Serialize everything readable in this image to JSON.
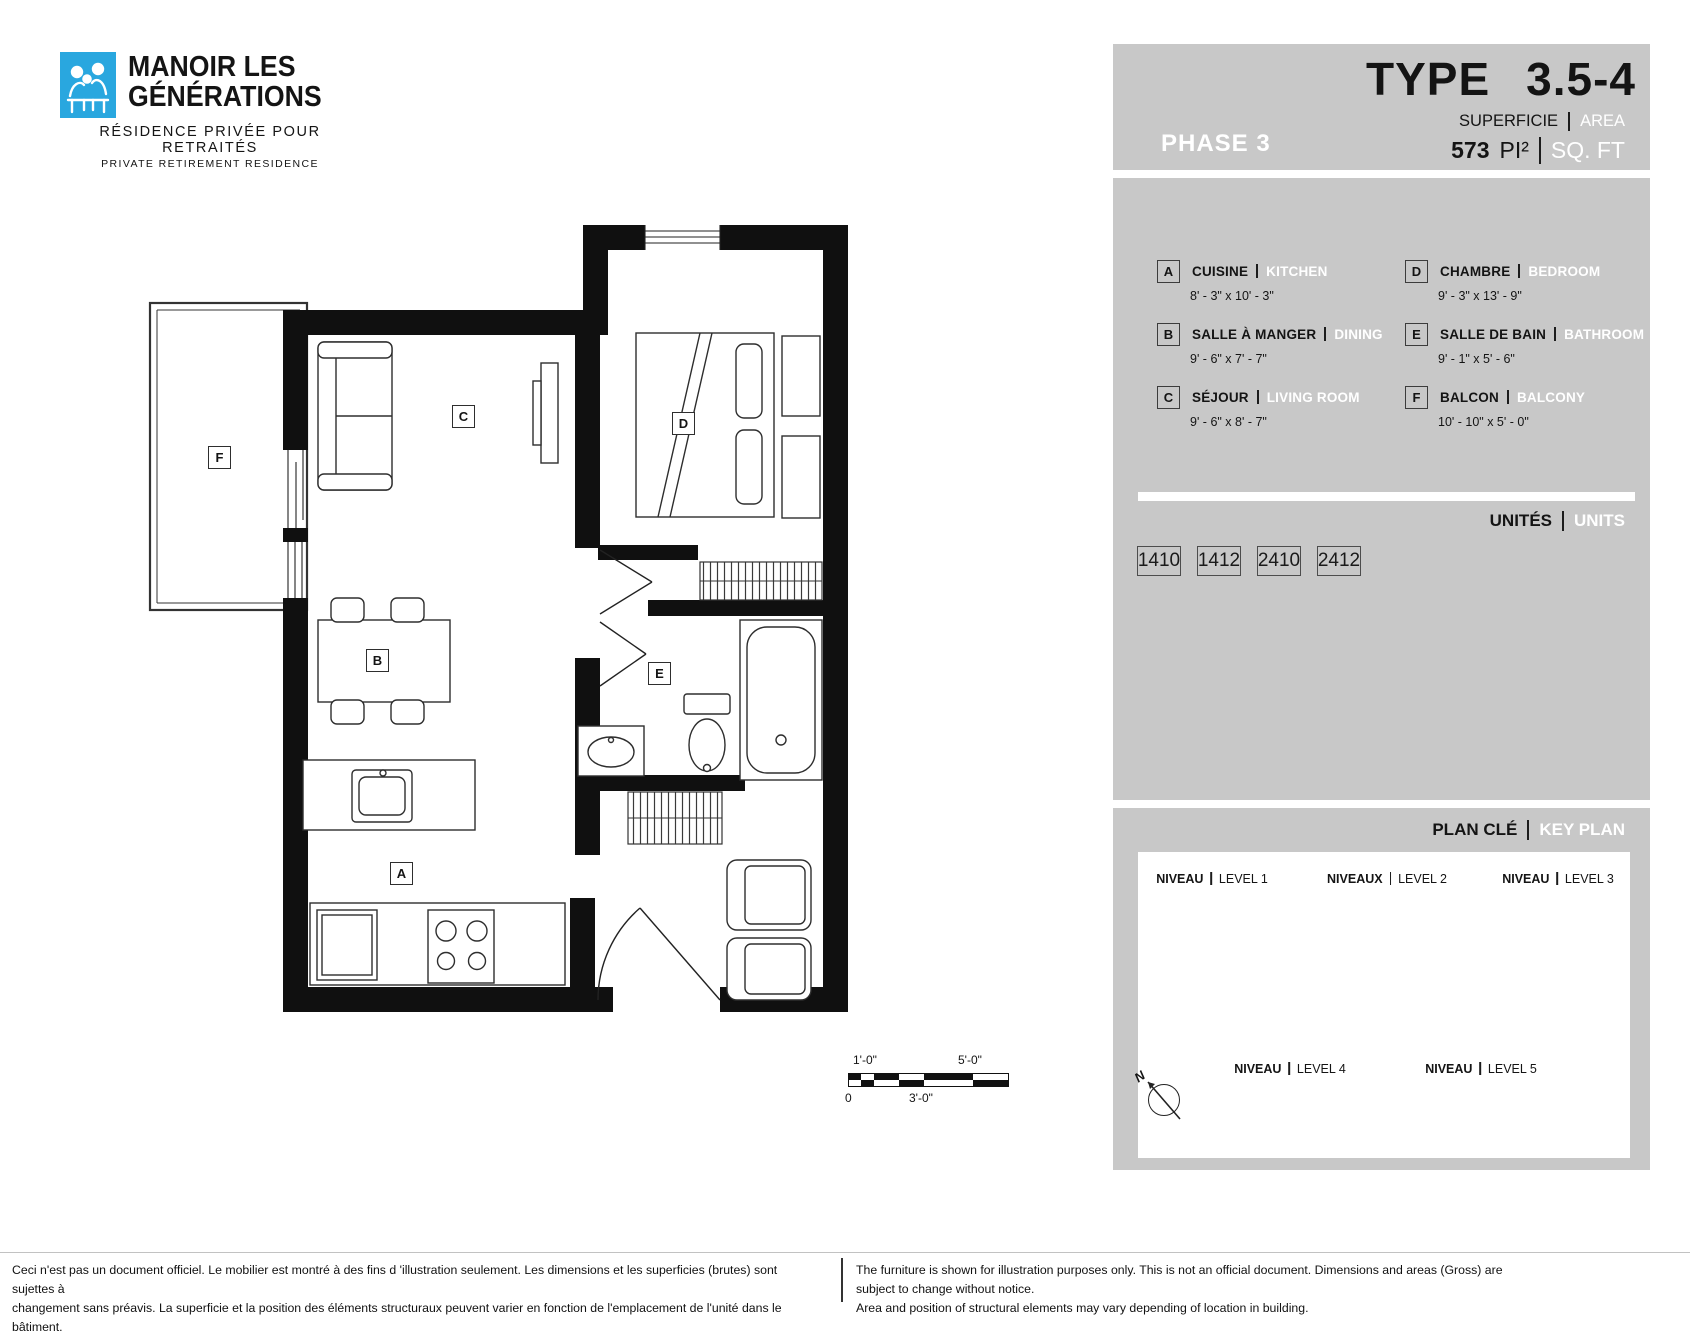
{
  "brand": {
    "name_line1": "MANOIR LES",
    "name_line2": "GÉNÉRATIONS",
    "tagline_fr": "RÉSIDENCE PRIVÉE POUR RETRAITÉS",
    "tagline_en": "PRIVATE RETIREMENT RESIDENCE"
  },
  "header": {
    "phase": "PHASE 3",
    "type_label": "TYPE",
    "type_value": "3.5-4",
    "area_label_fr": "SUPERFICIE",
    "area_label_en": "AREA",
    "area_value": "573",
    "area_unit_fr": "PI²",
    "area_unit_en": "SQ. FT"
  },
  "legend": {
    "rooms": [
      {
        "letter": "A",
        "name_fr": "CUISINE",
        "name_en": "KITCHEN",
        "dimensions": "8' - 3\" x 10' - 3\""
      },
      {
        "letter": "B",
        "name_fr": "SALLE À MANGER",
        "name_en": "DINING",
        "dimensions": "9' - 6\" x 7' - 7\""
      },
      {
        "letter": "C",
        "name_fr": "SÉJOUR",
        "name_en": "LIVING ROOM",
        "dimensions": "9' - 6\" x 8' - 7\""
      },
      {
        "letter": "D",
        "name_fr": "CHAMBRE",
        "name_en": "BEDROOM",
        "dimensions": "9' - 3\" x 13' - 9\""
      },
      {
        "letter": "E",
        "name_fr": "SALLE DE BAIN",
        "name_en": "BATHROOM",
        "dimensions": "9' - 1\" x 5' - 6\""
      },
      {
        "letter": "F",
        "name_fr": "BALCON",
        "name_en": "BALCONY",
        "dimensions": "10' - 10\" x 5' - 0\""
      }
    ]
  },
  "units": {
    "label_fr": "UNITÉS",
    "label_en": "UNITS",
    "numbers": [
      "1410",
      "1412",
      "2410",
      "2412"
    ]
  },
  "key_plan": {
    "title_fr": "PLAN CLÉ",
    "title_en": "KEY PLAN",
    "levels": [
      {
        "label_fr": "NIVEAU",
        "label_en": "LEVEL 1",
        "highlighted": true
      },
      {
        "label_fr": "NIVEAUX",
        "label_en": "LEVEL 2",
        "highlighted": true
      },
      {
        "label_fr": "NIVEAU",
        "label_en": "LEVEL 3",
        "highlighted": false
      },
      {
        "label_fr": "NIVEAU",
        "label_en": "LEVEL 4",
        "highlighted": false
      },
      {
        "label_fr": "NIVEAU",
        "label_en": "LEVEL 5",
        "highlighted": false
      }
    ],
    "north_label": "N"
  },
  "scale_bar": {
    "label_top_left": "1'-0\"",
    "label_top_right": "5'-0\"",
    "label_bottom_left": "0",
    "label_bottom_mid": "3'-0\""
  },
  "disclaimers": {
    "fr_line1": "Ceci n'est pas un document officiel.  Le mobilier est montré à des fins d 'illustration seulement.  Les dimensions et les superficies (brutes) sont sujettes à",
    "fr_line2": "changement sans préavis. La superficie et la position des éléments structuraux peuvent varier en fonction de l'emplacement de l'unité dans le bâtiment.",
    "en_line1": "The furniture is shown for illustration purposes only.  This is not an official document.  Dimensions and areas (Gross) are subject to change without notice.",
    "en_line2": "Area and position of structural elements may vary depending of location in building."
  },
  "colors": {
    "brand_blue": "#29a7df",
    "panel_gray": "#c8c8c8",
    "highlight_cyan": "#b5e0ea"
  }
}
